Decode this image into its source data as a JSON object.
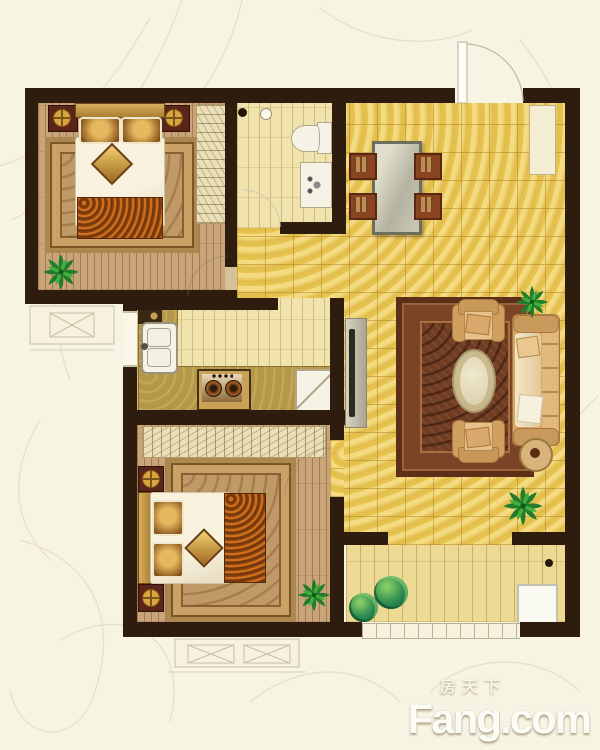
{
  "watermark": {
    "cn": "房天下",
    "en": "Fang.com"
  },
  "plan": {
    "type": "residential-floor-plan-2-bed",
    "rooms": [
      "master-bedroom",
      "bathroom",
      "entry-dining",
      "kitchen",
      "second-bedroom",
      "living-room",
      "balcony"
    ],
    "furniture": [
      "double-bed",
      "nightstand-lamps",
      "wardrobe",
      "bedroom-rug",
      "toilet",
      "wash-basin",
      "floor-drain",
      "dining-table",
      "four-dining-chairs",
      "shoe-cabinet",
      "entry-door",
      "kitchen-sink",
      "gas-stove",
      "refrigerator",
      "tv-stand",
      "three-seat-sofa",
      "two-armchairs",
      "oval-coffee-table",
      "side-table",
      "living-rug",
      "washing-machine",
      "potted-plants",
      "bay-windows"
    ],
    "palette": {
      "background": "#f8f4e3",
      "wall": "#2e1d0f",
      "tile_gold": "#e7c44f",
      "tile_pale": "#f0e3ae",
      "wood_floor": "#c8a478",
      "balcony_floor": "#ecd993",
      "living_rug": "#6f3d23",
      "bedroom_rug": "#c09a66",
      "sofa": "#d7a768",
      "counter": "#b59749",
      "plant_green": "#2e8a50"
    }
  }
}
